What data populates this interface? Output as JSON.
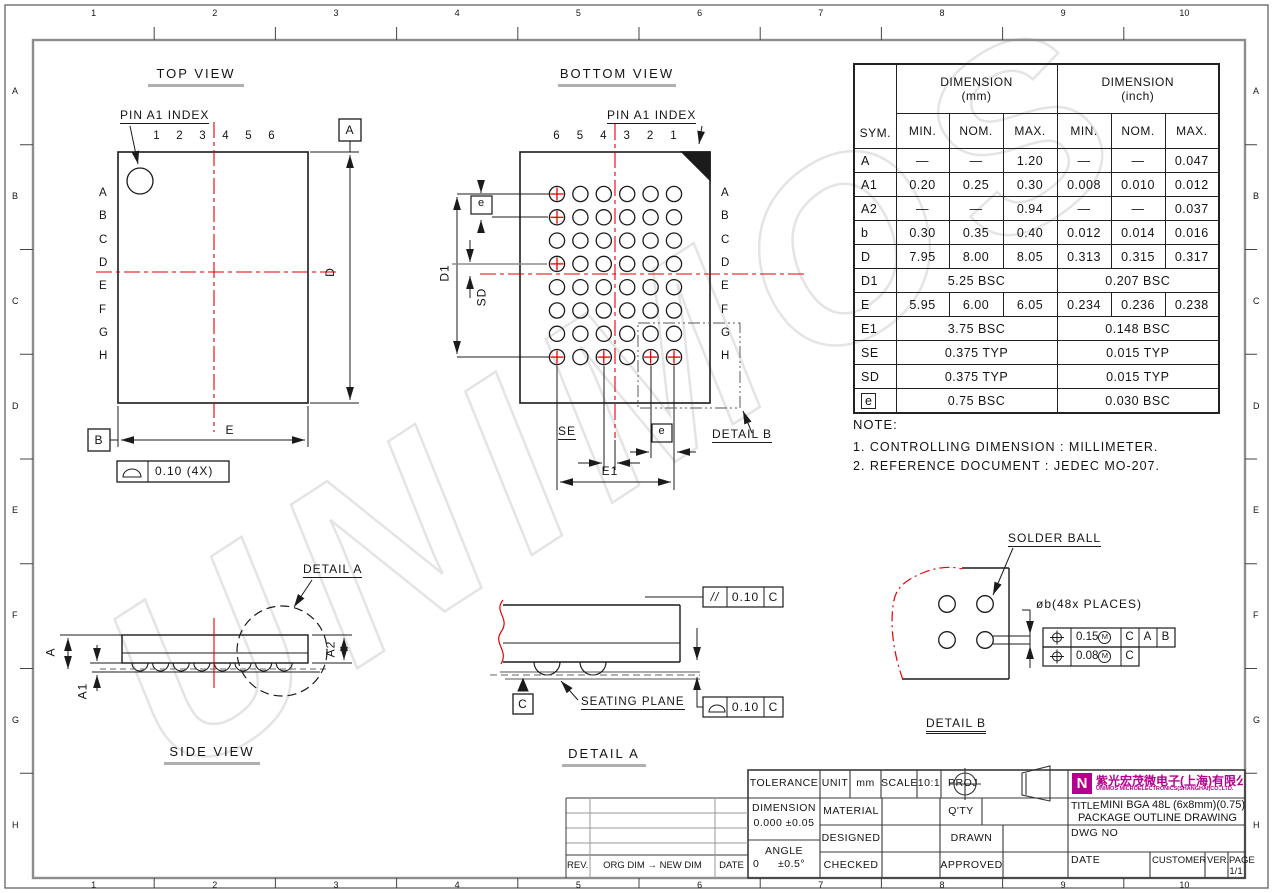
{
  "watermark": "UNIMOS",
  "colors": {
    "red": "#e60000",
    "line": "#1b1b1b",
    "gray": "#8d8d8d",
    "brand": "#b4008c",
    "watermark": "#e4e4e4"
  },
  "frame": {
    "columns": [
      "1",
      "2",
      "3",
      "4",
      "5",
      "6",
      "7",
      "8",
      "9",
      "10"
    ],
    "rows": [
      "A",
      "B",
      "C",
      "D",
      "E",
      "F",
      "G",
      "H"
    ]
  },
  "top_view": {
    "title": "TOP VIEW",
    "pin_index": "PIN A1 INDEX",
    "columns": [
      "1",
      "2",
      "3",
      "4",
      "5",
      "6"
    ],
    "rows": [
      "A",
      "B",
      "C",
      "D",
      "E",
      "F",
      "G",
      "H"
    ],
    "dim_d": "D",
    "dim_e": "E",
    "datum_a": "A",
    "datum_b": "B",
    "flatness_value": "0.10 (4X)"
  },
  "bottom_view": {
    "title": "BOTTOM VIEW",
    "pin_index": "PIN A1 INDEX",
    "columns": [
      "6",
      "5",
      "4",
      "3",
      "2",
      "1"
    ],
    "rows": [
      "A",
      "B",
      "C",
      "D",
      "E",
      "F",
      "G",
      "H"
    ],
    "marked_balls": [
      "A6",
      "B6",
      "D6",
      "H6",
      "H4",
      "H2",
      "H1"
    ],
    "dim_d1": "D1",
    "dim_sd": "SD",
    "dim_se": "SE",
    "dim_e1": "E1",
    "dim_e": "e",
    "detail_b_callout": "DETAIL B"
  },
  "side_view": {
    "title": "SIDE VIEW",
    "dim_a": "A",
    "dim_a1": "A1",
    "dim_a2": "A2",
    "detail_a_callout": "DETAIL A"
  },
  "detail_a": {
    "title": "DETAIL A",
    "seating_plane": "SEATING PLANE",
    "datum_c": "C",
    "parallel_symbol": "//",
    "parallel_tol": "0.10",
    "parallel_datum": "C",
    "flatness_tol": "0.10",
    "flatness_datum": "C"
  },
  "detail_b": {
    "title": "DETAIL B",
    "solder_ball": "SOLDER BALL",
    "diameter_note": "øb(48x PLACES)",
    "fcf": [
      {
        "tol": "0.15",
        "modifier": "M",
        "datums": [
          "C",
          "A",
          "B"
        ]
      },
      {
        "tol": "0.08",
        "modifier": "M",
        "datums": [
          "C"
        ]
      }
    ]
  },
  "notes": {
    "heading": "NOTE:",
    "items": [
      "1. CONTROLLING DIMENSION : MILLIMETER.",
      "2. REFERENCE DOCUMENT : JEDEC MO-207."
    ]
  },
  "table": {
    "header": {
      "sym": "SYM.",
      "dimension": "DIMENSION",
      "mm": "(mm)",
      "inch": "(inch)",
      "min": "MIN.",
      "nom": "NOM.",
      "max": "MAX."
    },
    "rows": [
      {
        "sym": "A",
        "mm": [
          "—",
          "—",
          "1.20"
        ],
        "inch": [
          "—",
          "—",
          "0.047"
        ]
      },
      {
        "sym": "A1",
        "mm": [
          "0.20",
          "0.25",
          "0.30"
        ],
        "inch": [
          "0.008",
          "0.010",
          "0.012"
        ]
      },
      {
        "sym": "A2",
        "mm": [
          "—",
          "—",
          "0.94"
        ],
        "inch": [
          "—",
          "—",
          "0.037"
        ]
      },
      {
        "sym": "b",
        "mm": [
          "0.30",
          "0.35",
          "0.40"
        ],
        "inch": [
          "0.012",
          "0.014",
          "0.016"
        ]
      },
      {
        "sym": "D",
        "mm": [
          "7.95",
          "8.00",
          "8.05"
        ],
        "inch": [
          "0.313",
          "0.315",
          "0.317"
        ]
      },
      {
        "sym": "D1",
        "mm_span": "5.25 BSC",
        "inch_span": "0.207 BSC"
      },
      {
        "sym": "E",
        "mm": [
          "5.95",
          "6.00",
          "6.05"
        ],
        "inch": [
          "0.234",
          "0.236",
          "0.238"
        ]
      },
      {
        "sym": "E1",
        "mm_span": "3.75 BSC",
        "inch_span": "0.148 BSC"
      },
      {
        "sym": "SE",
        "mm_span": "0.375 TYP",
        "inch_span": "0.015 TYP"
      },
      {
        "sym": "SD",
        "mm_span": "0.375 TYP",
        "inch_span": "0.015 TYP"
      },
      {
        "sym": "e",
        "boxed": true,
        "mm_span": "0.75 BSC",
        "inch_span": "0.030 BSC"
      }
    ]
  },
  "title_block": {
    "tolerance": "TOLERANCE",
    "unit_label": "UNIT",
    "unit_value": "mm",
    "scale_label": "SCALE",
    "scale_value": "10:1",
    "proj_label": "PROJ",
    "dimension_label": "DIMENSION",
    "dimension_tol": "0.000 ±0.05",
    "angle_label": "ANGLE",
    "angle_zero": "0",
    "angle_tol": "±0.5°",
    "material": "MATERIAL",
    "designed": "DESIGNED",
    "checked": "CHECKED",
    "qty": "Q'TY",
    "drawn": "DRAWN",
    "approved": "APPROVED",
    "title_label": "TITLE",
    "title_line1": "MINI BGA 48L (6x8mm)(0.75)",
    "title_line2": "PACKAGE OUTLINE DRAWING",
    "dwg_no": "DWG NO",
    "date": "DATE",
    "customer": "CUSTOMER",
    "ver": "VER.",
    "page_label": "PAGE",
    "page_value": "1/1",
    "logo_letter": "N",
    "company_cn": "紫光宏茂微电子(上海)有限公司",
    "company_en": "UNIMOS MICROELECTRONICS(SHANGHAI)CO.,LTD."
  },
  "revision_table": {
    "rev": "REV.",
    "change": "ORG DIM → NEW DIM",
    "date": "DATE"
  }
}
